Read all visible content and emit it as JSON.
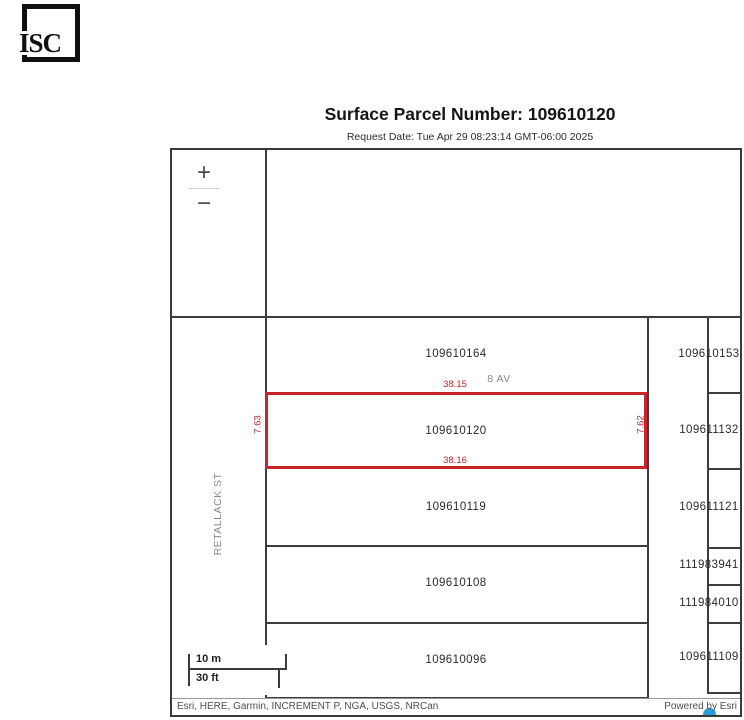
{
  "logo": {
    "text": "ISC"
  },
  "header": {
    "title": "Surface Parcel Number: 109610120",
    "request_date": "Request Date: Tue Apr 29 08:23:14 GMT-06:00 2025"
  },
  "map": {
    "street_labels": {
      "avenue": "8 AV",
      "street": "RETALLACK ST"
    },
    "zoom_control": {
      "zoom_in": "+",
      "zoom_out": "−"
    },
    "target_parcel": {
      "number": "109610120",
      "dim_top": "38.15",
      "dim_bottom": "38.16",
      "dim_left": "7.63",
      "dim_right": "7.62",
      "highlight_color": "#c9252a"
    },
    "block_parcels": [
      "109610164",
      "109610120",
      "109610119",
      "109610108",
      "109610096"
    ],
    "east_parcels": [
      "109610153",
      "109611132",
      "109611121",
      "111983941",
      "111984010",
      "109611109"
    ],
    "scalebar": {
      "metric": "10 m",
      "imperial": "30 ft"
    },
    "attribution": "Esri, HERE, Garmin, INCREMENT P, NGA, USGS, NRCan",
    "powered_by": "Powered by Esri"
  },
  "colors": {
    "boundary_line": "#3d3d3d",
    "highlight_red": "#c9252a",
    "road_label_gray": "#8a8a8a",
    "esri_blue": "#2b9cd8"
  }
}
